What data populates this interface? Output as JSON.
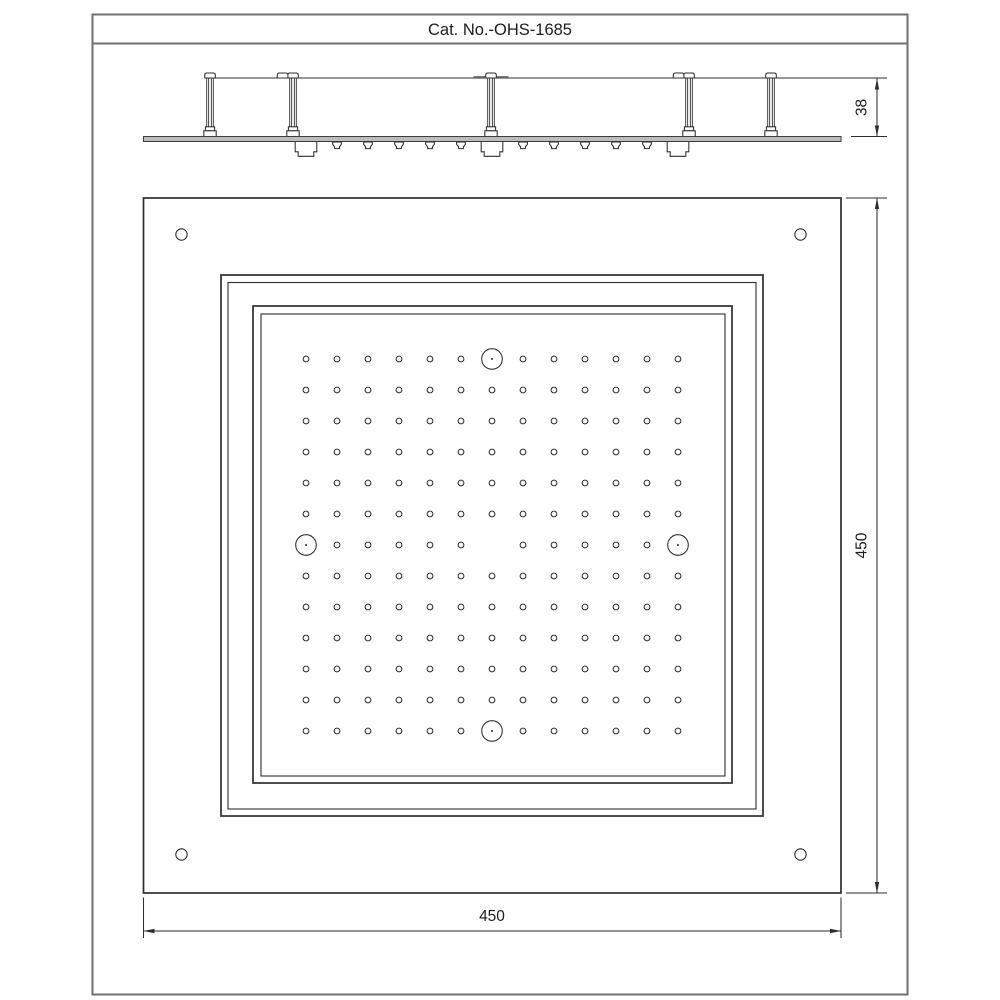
{
  "title": "Cat. No.-OHS-1685",
  "dimensions": {
    "side_height": "38",
    "front_height": "450",
    "front_width": "450"
  },
  "front_view": {
    "hole_grid": {
      "rows": 13,
      "cols": 13,
      "spacing": 31,
      "origin_x": 306,
      "origin_y": 359,
      "hole_radius": 2.9,
      "skip_cells": [
        [
          1,
          7
        ],
        [
          7,
          1
        ],
        [
          7,
          7
        ],
        [
          7,
          13
        ],
        [
          13,
          7
        ]
      ]
    },
    "function_circles": {
      "radius": 10.3,
      "dot_radius": 1.05,
      "centers": [
        [
          492,
          359
        ],
        [
          306,
          545
        ],
        [
          678,
          545
        ],
        [
          492,
          731
        ]
      ]
    },
    "corner_holes": {
      "radius": 5.7,
      "centers": [
        [
          181.5,
          234.5
        ],
        [
          800.5,
          234.5
        ],
        [
          181.5,
          854.5
        ],
        [
          800.5,
          854.5
        ]
      ]
    }
  },
  "side_view": {
    "posts": [
      {
        "x": 210,
        "double_cap": false,
        "wide_flange": false
      },
      {
        "x": 293,
        "double_cap": true,
        "wide_flange": false
      },
      {
        "x": 491,
        "double_cap": false,
        "wide_flange": true
      },
      {
        "x": 689,
        "double_cap": true,
        "wide_flange": false
      },
      {
        "x": 771,
        "double_cap": false,
        "wide_flange": false
      }
    ],
    "nozzle_xs": [
      337,
      368,
      399,
      430,
      461,
      523,
      554,
      585,
      616,
      647
    ],
    "inlet_box_xs": [
      306,
      492,
      678
    ]
  },
  "colors": {
    "line": "#2e2e2e",
    "frame_border": "#6f6f6f",
    "plate_fill": "#bcbcbc",
    "text": "#1c1c1c"
  }
}
